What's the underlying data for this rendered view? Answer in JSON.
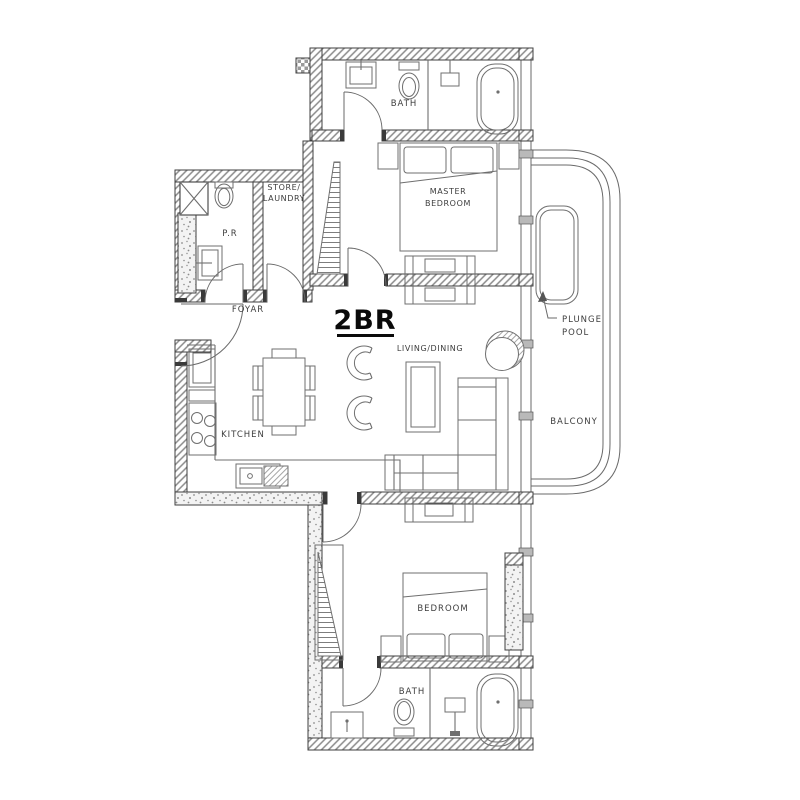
{
  "plan": {
    "unit_type": "2BR",
    "rooms": {
      "master_bath": {
        "label": "BATH"
      },
      "store_laundry": {
        "line1": "STORE/",
        "line2": "LAUNDRY"
      },
      "powder_room": {
        "label": "P.R"
      },
      "master_bedroom": {
        "line1": "MASTER",
        "line2": "BEDROOM"
      },
      "foyer": {
        "label": "FOYAR"
      },
      "living_dining": {
        "label": "LIVING/DINING"
      },
      "kitchen": {
        "label": "KITCHEN"
      },
      "plunge_pool": {
        "line1": "PLUNGE",
        "line2": "POOL"
      },
      "balcony": {
        "label": "BALCONY"
      },
      "bedroom": {
        "label": "BEDROOM"
      },
      "bath": {
        "label": "BATH"
      }
    },
    "colors": {
      "background": "#ffffff",
      "wall_edge": "#3f3f3f",
      "line": "#6a6a6a",
      "text": "#3d3d3d",
      "title": "#0a0a0a"
    }
  }
}
